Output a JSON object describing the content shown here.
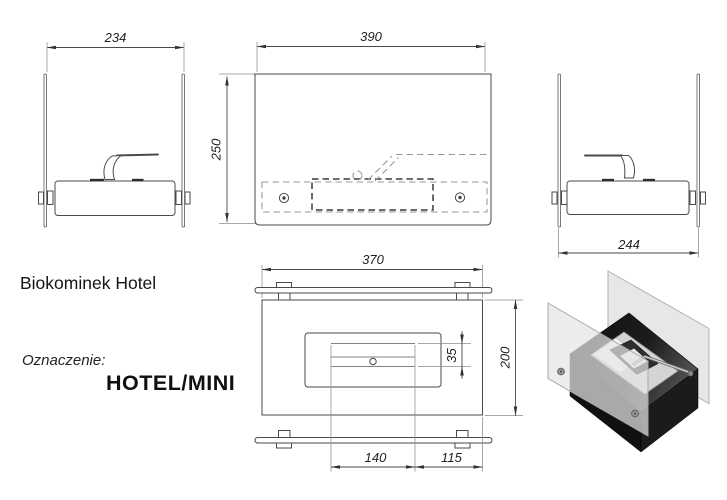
{
  "sheet": {
    "title": "Biokominek Hotel",
    "designation_label": "Oznaczenie:",
    "designation_value": "HOTEL/MINI",
    "background": "#ffffff"
  },
  "dimensions": {
    "side_left_width": "234",
    "front_width": "390",
    "front_height": "250",
    "side_right_width": "244",
    "top_width": "370",
    "top_depth": "200",
    "slot_height": "35",
    "opening_width": "140",
    "opening_to_edge": "115"
  },
  "colors": {
    "line": "#4a4a4a",
    "hidden_line": "#9a9a9a",
    "glass_3d": "#e7e7e7",
    "burner_3d": "#111111",
    "insert_3d": "#d4d4d4"
  }
}
